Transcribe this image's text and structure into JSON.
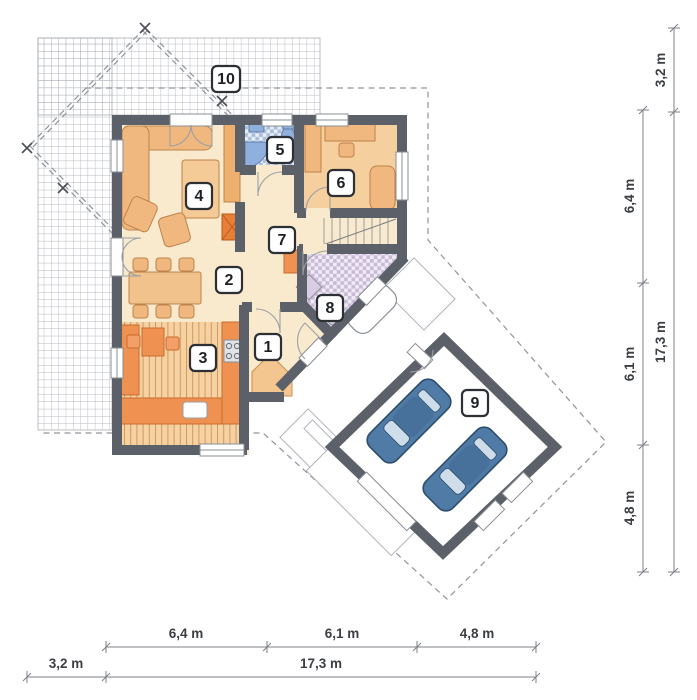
{
  "plan": {
    "type": "house-first-floor-plan",
    "room_labels": [
      "1",
      "2",
      "3",
      "4",
      "5",
      "6",
      "7",
      "8",
      "9",
      "10"
    ]
  },
  "dimensions": {
    "bottom": {
      "segments": [
        "6,4 m",
        "6,1 m",
        "4,8 m"
      ],
      "offset": "3,2 m",
      "total": "17,3 m"
    },
    "right": {
      "segments": [
        "6,4 m",
        "6,1 m",
        "4,8 m"
      ],
      "offset": "3,2 m",
      "total": "17,3 m"
    }
  },
  "colors": {
    "wall": "#5c6169",
    "floor": "#faeacd",
    "room6_floor": "#f5cf9e",
    "kitchen_wood": "#f6d1a2",
    "counter_orange": "#ef9150",
    "furniture_tan": "#f0b87e",
    "fireplace_orange": "#e87f36",
    "bath_fixture_blue": "#8fb0dc",
    "wc_check_blue": "#a9bedd",
    "bath_check_lilac": "#c9bad7",
    "car": "#4f7ba6",
    "terrace_grid_line": "#b5b9c0",
    "roof_dash": "#8f949b",
    "dim_text": "#3b3e43",
    "badge_border": "#2c2f33"
  }
}
